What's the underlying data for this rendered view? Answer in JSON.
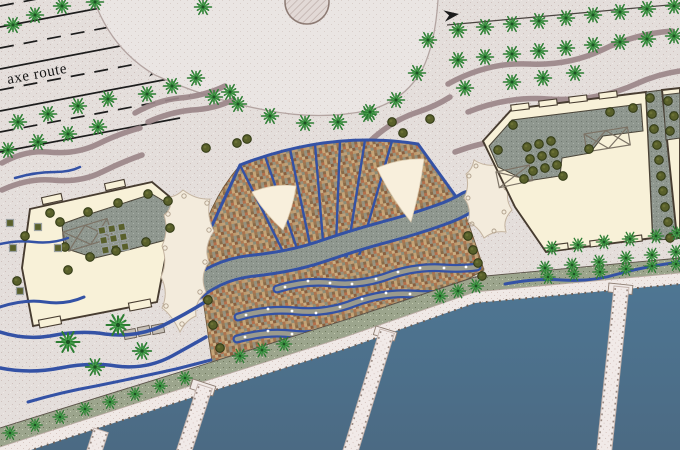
{
  "road": {
    "label": "axe route",
    "lanes": {
      "left_arrow_count": 2,
      "right_arrow_count": 2
    }
  },
  "icons": {
    "lane_arrow_left": "◄",
    "lane_arrow_right": "►",
    "direction_arrow": "➤",
    "palm_tree": "starburst",
    "olive_tree": "filled-circle",
    "planter": "square",
    "pergola": "x-frame"
  },
  "colors": {
    "background": "#e4dedb",
    "dots": "#cfc1bd",
    "plaza": "#eae5e3",
    "road_line": "#1c1c1c",
    "path": "#9b8689",
    "blue": "#3452a5",
    "building": "#f8f1d8",
    "building_outline": "#473c30",
    "courtyard": "#8f978f",
    "strip": "#9ca58d",
    "quay": "#f0e9e6",
    "pier": "#f1eae8",
    "mosaic": "#a5835c",
    "mosaic_palette": "#b46f4b #c6a77a #8a6a48 #97927c #c9ae84 #8a5e3e",
    "sail": "#f8efdc",
    "tent": "#f3ebdc",
    "palm": "#2d7d33",
    "palm_light": "#45a04b",
    "olive": "#59602b",
    "water_top": "#4e7693",
    "water_bottom": "#4b6a83",
    "fountain": "#e2d9d6"
  }
}
